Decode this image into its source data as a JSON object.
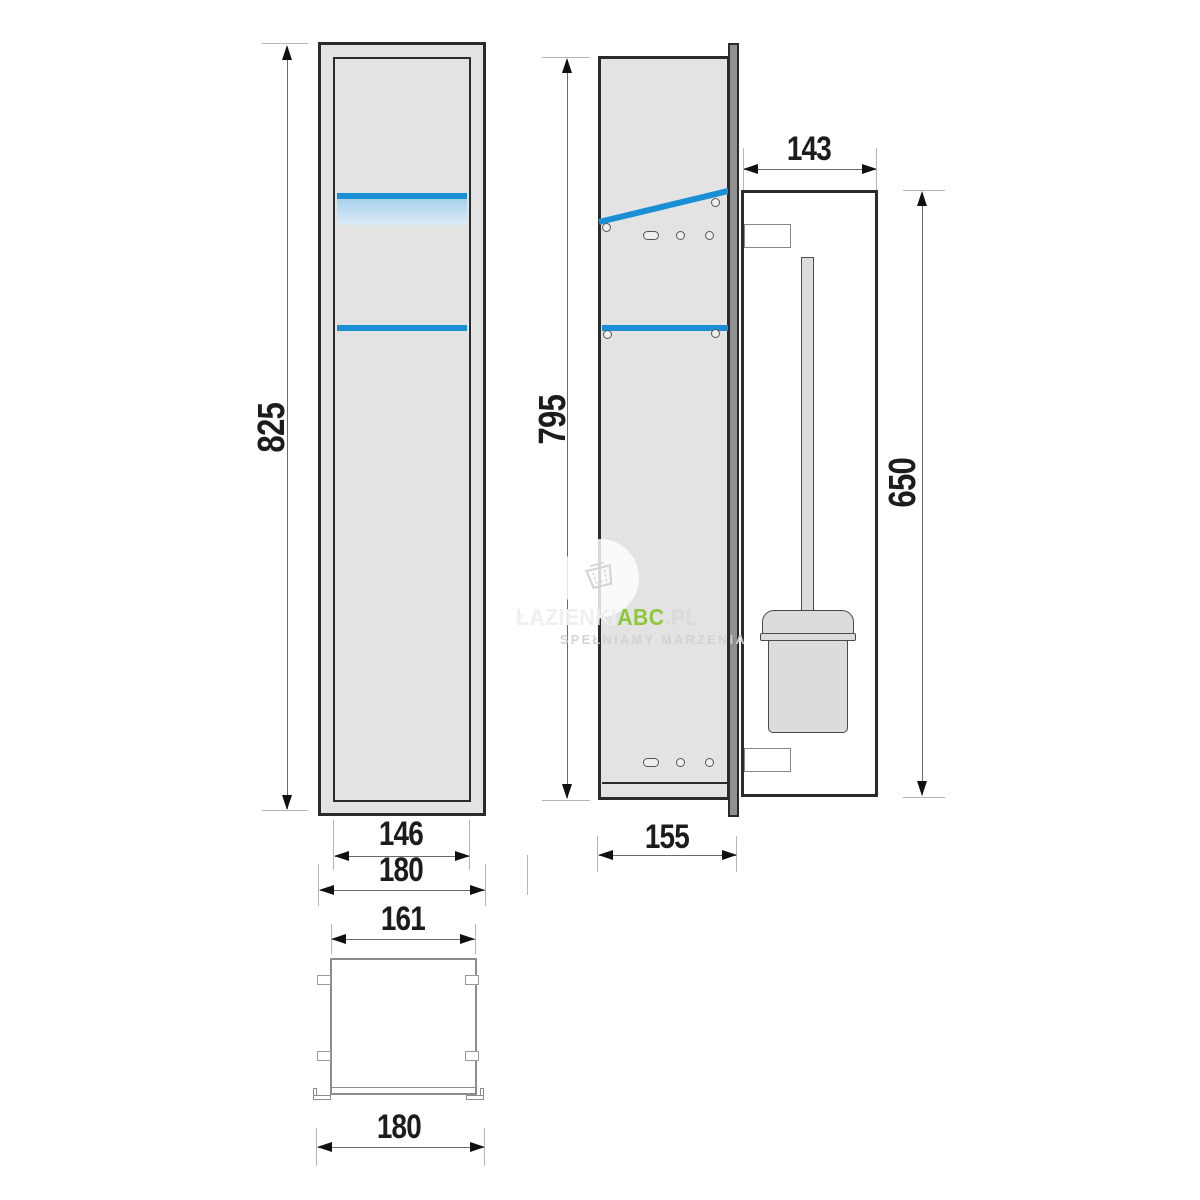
{
  "views": {
    "front": {
      "height": "825",
      "inner_width": "146",
      "outer_width": "180"
    },
    "side": {
      "height": "795",
      "depth": "155"
    },
    "niche": {
      "width": "143",
      "brush_zone_height": "650"
    },
    "plan": {
      "inner_width": "161",
      "outer_width": "180"
    }
  },
  "watermark": {
    "brand_prefix": "ŁAZIENKI",
    "brand_accent": "ABC",
    "brand_suffix": ".PL",
    "tagline": "SPEŁNIAMY MARZENIA",
    "accent_color": "#8dc63f"
  },
  "colors": {
    "highlight_blue": "#1b8fd6",
    "highlight_blue_light": "#b4d8ee",
    "panel_gray": "#e3e3e3",
    "door_edge_gray": "#909090",
    "outline_dark": "#2b2b2b"
  }
}
